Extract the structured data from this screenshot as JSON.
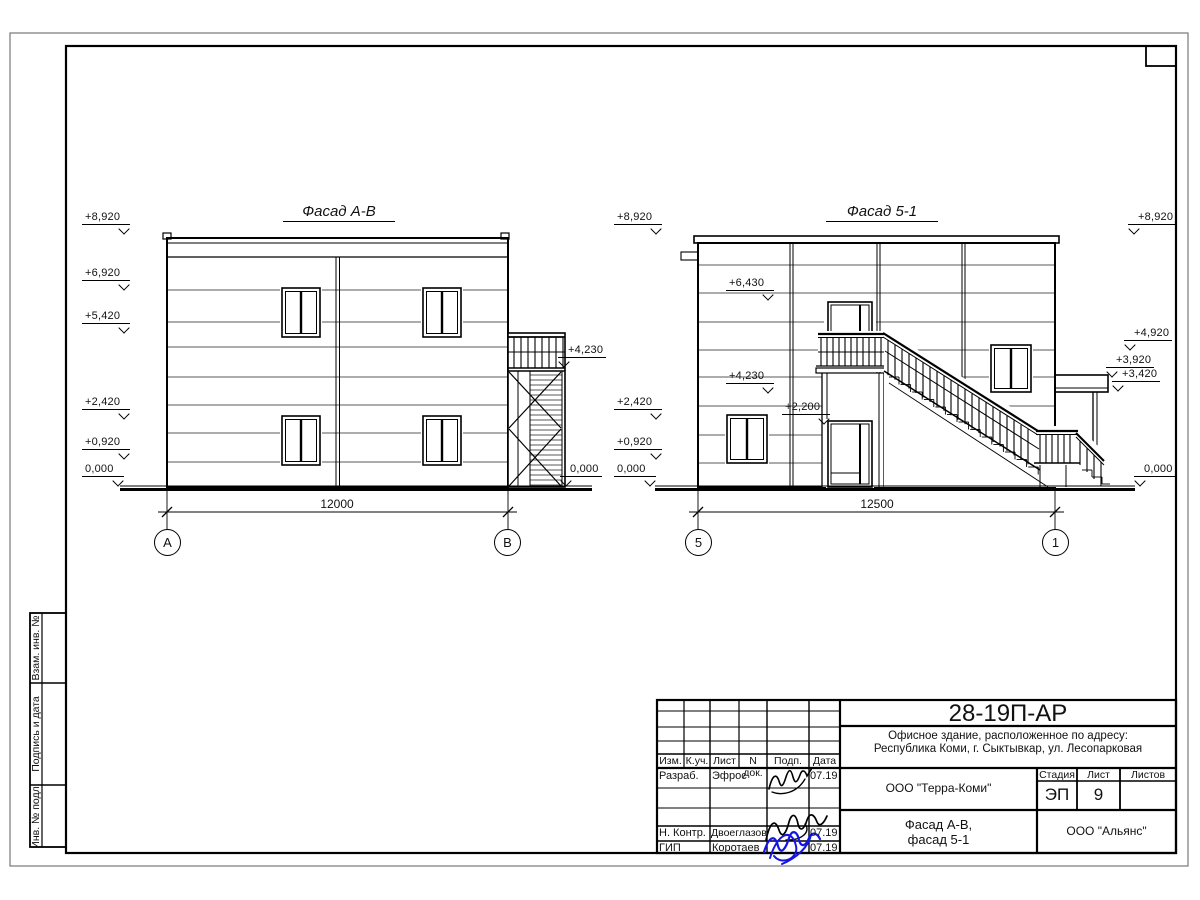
{
  "drawing": {
    "facade_left": {
      "title": "Фасад А-В",
      "dimension": "12000",
      "axis_left": "А",
      "axis_right": "В",
      "marks_left": [
        "+8,920",
        "+6,920",
        "+5,420",
        "+2,420",
        "+0,920",
        "0,000"
      ],
      "marks_right": [
        "+4,230",
        "0,000"
      ]
    },
    "facade_right": {
      "title": "Фасад 5-1",
      "dimension": "12500",
      "axis_left": "5",
      "axis_right": "1",
      "marks_left": [
        "+8,920",
        "+2,420",
        "+0,920",
        "0,000"
      ],
      "marks_inner": [
        "+6,430",
        "+4,230",
        "+2,200"
      ],
      "marks_right": [
        "+8,920",
        "+4,920",
        "+3,920",
        "+3,420",
        "0,000"
      ]
    }
  },
  "title_block": {
    "project_code": "28-19П-АР",
    "address_line1": "Офисное здание, расположенное по адресу:",
    "address_line2": "Республика Коми, г. Сыктывкар, ул. Лесопарковая",
    "client_org": "ООО \"Терра-Коми\"",
    "sheet_title_line1": "Фасад А-В,",
    "sheet_title_line2": "фасад 5-1",
    "contractor_org": "ООО \"Альянс\"",
    "stage_label": "Стадия",
    "stage_value": "ЭП",
    "sheet_label": "Лист",
    "sheet_value": "9",
    "sheets_label": "Листов",
    "sheets_value": "",
    "header": {
      "izm": "Изм.",
      "kuch": "К.уч.",
      "list": "Лист",
      "ndok": "N док.",
      "podp": "Подп.",
      "data": "Дата"
    },
    "rows": [
      {
        "role": "Разраб.",
        "name": "Эфрос",
        "date": "07.19"
      },
      {
        "role": "Н. Контр.",
        "name": "Двоеглазов",
        "date": "07.19"
      },
      {
        "role": "ГИП",
        "name": "Коротаев",
        "date": "07.19"
      }
    ]
  },
  "side_strip": {
    "cell1": "Взам. инв. №",
    "cell2": "Подпись и дата",
    "cell3": "Инв. № подл."
  },
  "colors": {
    "line": "#000000",
    "signature_blue": "#1414e6"
  }
}
